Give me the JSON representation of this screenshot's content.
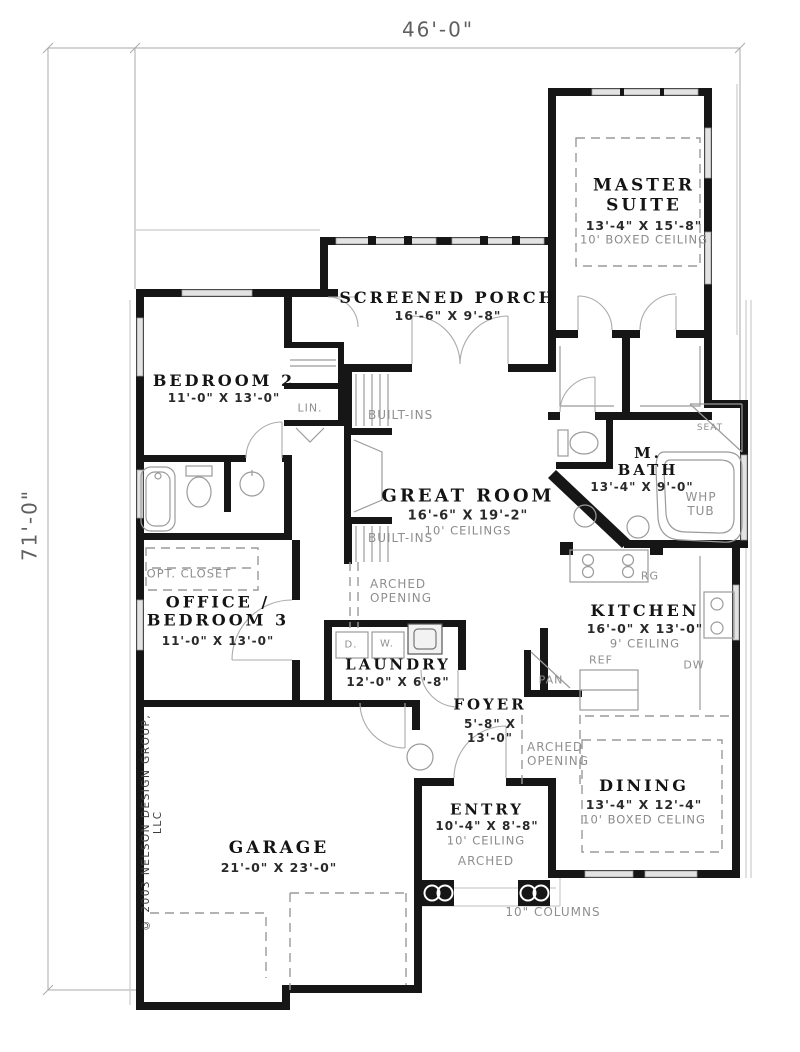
{
  "plan": {
    "width_dim": "46'-0\"",
    "height_dim": "71'-0\"",
    "copyright": "© 2003 NELSON DESIGN GROUP, LLC",
    "rooms": {
      "master_suite": {
        "name": "MASTER SUITE",
        "size": "13'-4\" X 15'-8\"",
        "ceiling": "10' BOXED CEILING"
      },
      "screened_porch": {
        "name": "SCREENED PORCH",
        "size": "16'-6\" X 9'-8\""
      },
      "bedroom2": {
        "name": "BEDROOM 2",
        "size": "11'-0\" X 13'-0\""
      },
      "great_room": {
        "name": "GREAT ROOM",
        "size": "16'-6\" X 19'-2\"",
        "ceiling": "10' CEILINGS"
      },
      "m_bath": {
        "name": "M. BATH",
        "size": "13'-4\" X 9'-0\""
      },
      "kitchen": {
        "name": "KITCHEN",
        "size": "16'-0\" X 13'-0\"",
        "ceiling": "9' CEILING"
      },
      "office_bedroom3": {
        "name": "OFFICE / BEDROOM 3",
        "size": "11'-0\" X 13'-0\""
      },
      "laundry": {
        "name": "LAUNDRY",
        "size": "12'-0\" X 6'-8\""
      },
      "foyer": {
        "name": "FOYER",
        "size": "5'-8\" X 13'-0\""
      },
      "dining": {
        "name": "DINING",
        "size": "13'-4\" X 12'-4\"",
        "ceiling": "10' BOXED CELING"
      },
      "entry": {
        "name": "ENTRY",
        "size": "10'-4\" X 8'-8\"",
        "ceiling": "10' CEILING",
        "note": "ARCHED"
      },
      "garage": {
        "name": "GARAGE",
        "size": "21'-0\" X 23'-0\""
      }
    },
    "labels": {
      "lin": "LIN.",
      "built_ins_upper": "BUILT-INS",
      "built_ins_lower": "BUILT-INS",
      "opt_closet": "OPT. CLOSET",
      "arched_opening_hall": "ARCHED OPENING",
      "arched_opening_dining": "ARCHED OPENING",
      "whp_tub": "WHP TUB",
      "seat": "SEAT",
      "range": "RG",
      "refrigerator": "REF",
      "pantry": "PAN",
      "dishwasher": "DW",
      "dryer": "D.",
      "washer": "W.",
      "columns": "10\" COLUMNS"
    }
  }
}
